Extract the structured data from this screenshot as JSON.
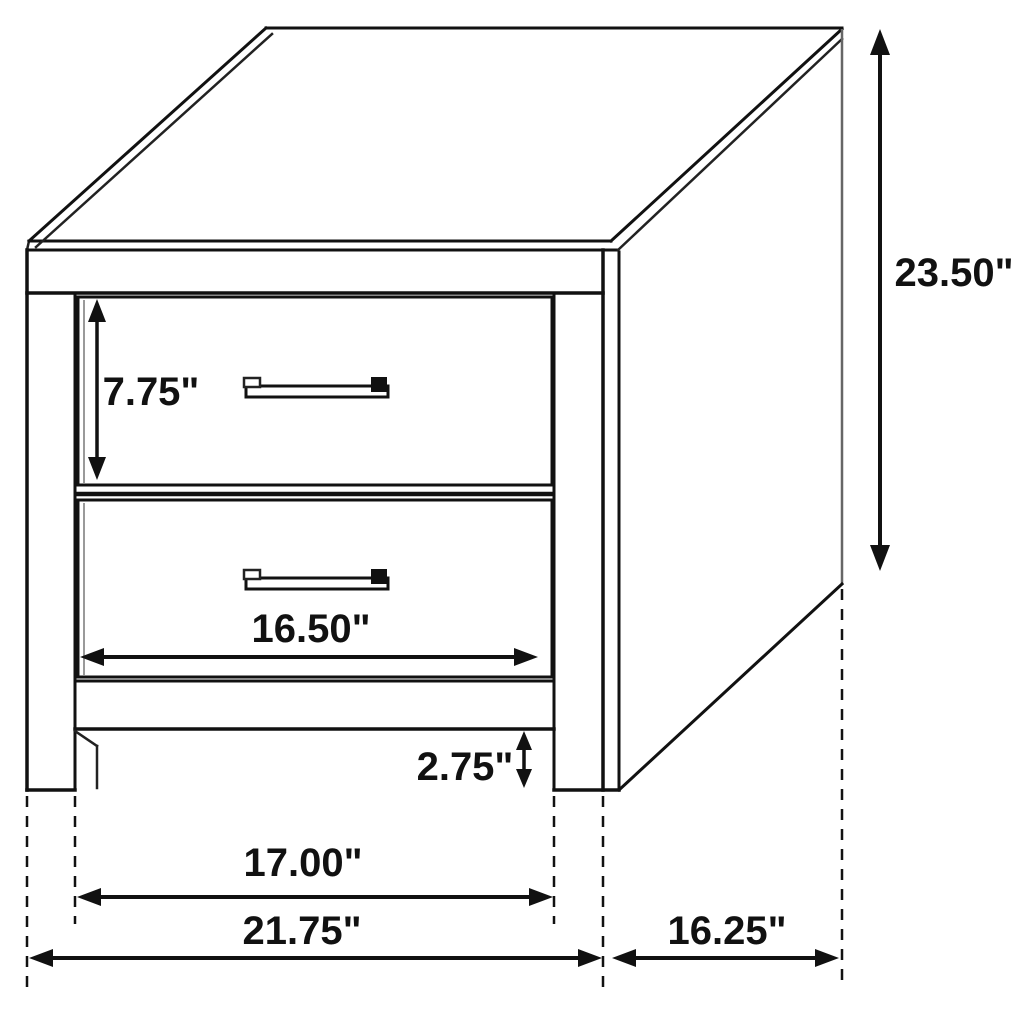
{
  "labels": {
    "height": "23.50\"",
    "drawer_height": "7.75\"",
    "drawer_width": "16.50\"",
    "leg_height": "2.75\"",
    "leg_spacing_width": "17.00\"",
    "overall_width": "21.75\"",
    "depth": "16.25\""
  },
  "colors": {
    "line": "#111111",
    "background": "#ffffff"
  }
}
